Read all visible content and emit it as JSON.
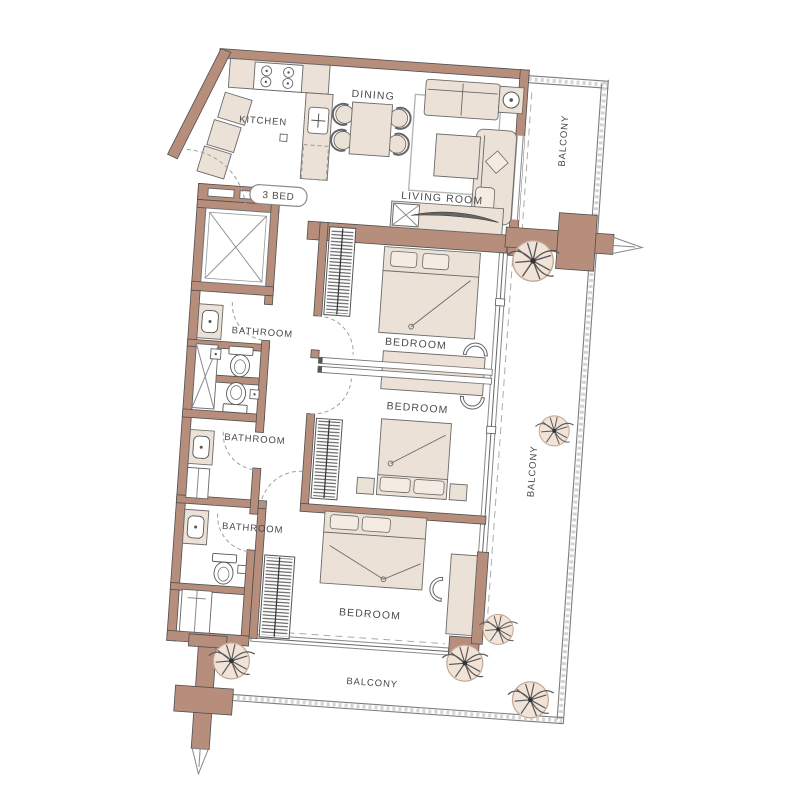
{
  "plan": {
    "unit_badge": "3 BED",
    "rooms": {
      "kitchen": "KITCHEN",
      "dining": "DINING",
      "living": "LIVING ROOM",
      "bedroom1": "BEDROOM",
      "bedroom2": "BEDROOM",
      "bedroom3": "BEDROOM",
      "bathroom1": "BATHROOM",
      "bathroom2": "BATHROOM",
      "bathroom3": "BATHROOM",
      "balcony_right_upper": "BALCONY",
      "balcony_right_lower": "BALCONY",
      "balcony_bottom": "BALCONY"
    },
    "colors": {
      "wall": "#b78d7b",
      "furniture": "#ece1d6",
      "background": "#ffffff",
      "line": "#4f4f4f"
    }
  }
}
